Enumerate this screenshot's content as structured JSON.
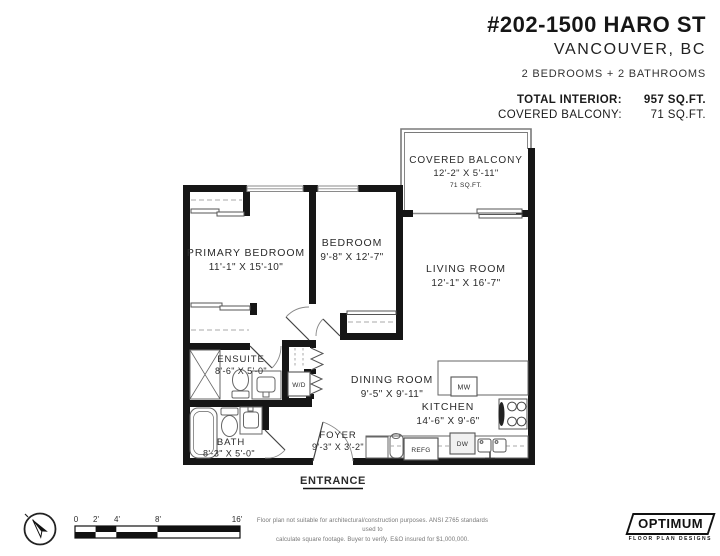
{
  "header": {
    "address": "#202-1500 HARO ST",
    "city": "VANCOUVER, BC",
    "summary": "2 BEDROOMS + 2 BATHROOMS",
    "stats": [
      {
        "label": "TOTAL INTERIOR:",
        "value": "957 SQ.FT."
      },
      {
        "label": "COVERED BALCONY:",
        "value": "71 SQ.FT."
      }
    ]
  },
  "rooms": {
    "covered_balcony": {
      "name": "COVERED BALCONY",
      "dims": "12'-2\" X 5'-11\"",
      "area": "71 SQ.FT."
    },
    "primary_bedroom": {
      "name": "PRIMARY BEDROOM",
      "dims": "11'-1\" X 15'-10\""
    },
    "bedroom": {
      "name": "BEDROOM",
      "dims": "9'-8\" X 12'-7\""
    },
    "living_room": {
      "name": "LIVING ROOM",
      "dims": "12'-1\" X 16'-7\""
    },
    "dining_room": {
      "name": "DINING ROOM",
      "dims": "9'-5\" X 9'-11\""
    },
    "kitchen": {
      "name": "KITCHEN",
      "dims": "14'-6\" X 9'-6\""
    },
    "ensuite": {
      "name": "ENSUITE",
      "dims": "8'-6\" X 5'-0\""
    },
    "bath": {
      "name": "BATH",
      "dims": "8'-3\" X 5'-0\""
    },
    "foyer": {
      "name": "FOYER",
      "dims": "9'-3\" X 3'-2\""
    }
  },
  "labels": {
    "entrance": "ENTRANCE",
    "washer_dryer": "W/D",
    "microwave": "MW",
    "fridge": "REFG",
    "dishwasher": "DW"
  },
  "scale_bar": {
    "ticks": [
      "0",
      "2'",
      "4'",
      "8'",
      "16'"
    ]
  },
  "footer": {
    "disclaimer_line1": "Floor plan not suitable for architectural/construction purposes. ANSI Z765 standards used to",
    "disclaimer_line2": "calculate square footage. Buyer to verify.  E&O insured for $1,000,000.",
    "logo": {
      "name": "OPTIMUM",
      "tagline": "FLOOR PLAN DESIGNS"
    }
  },
  "colors": {
    "wall": "#161616",
    "text": "#2b2b2b",
    "fixture": "#555555",
    "muted": "#999999"
  }
}
